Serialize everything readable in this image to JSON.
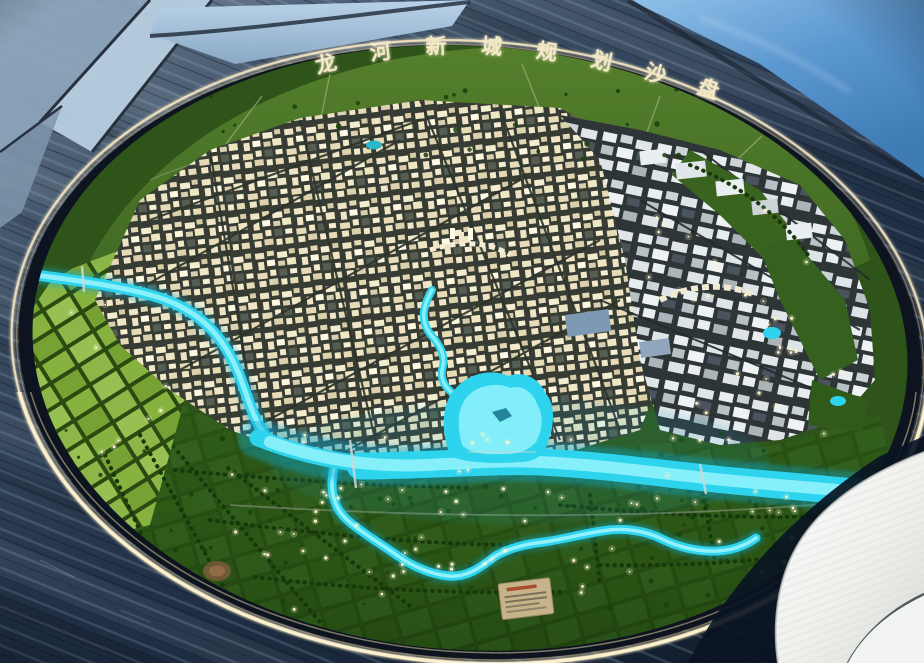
{
  "title": {
    "text": "龙河新城规划沙盘"
  },
  "palette": {
    "river": "#2ed3ee",
    "river_core": "#8ff2fb",
    "river_glow": "#0fa8d0",
    "farmland": "#81ab3d",
    "fields": "#2e5a18",
    "rim_light": "#ffeec6",
    "title_glow": "#f3e9c6",
    "floor": "#2c3c50",
    "sky_reflection": "#6ea6d8"
  }
}
